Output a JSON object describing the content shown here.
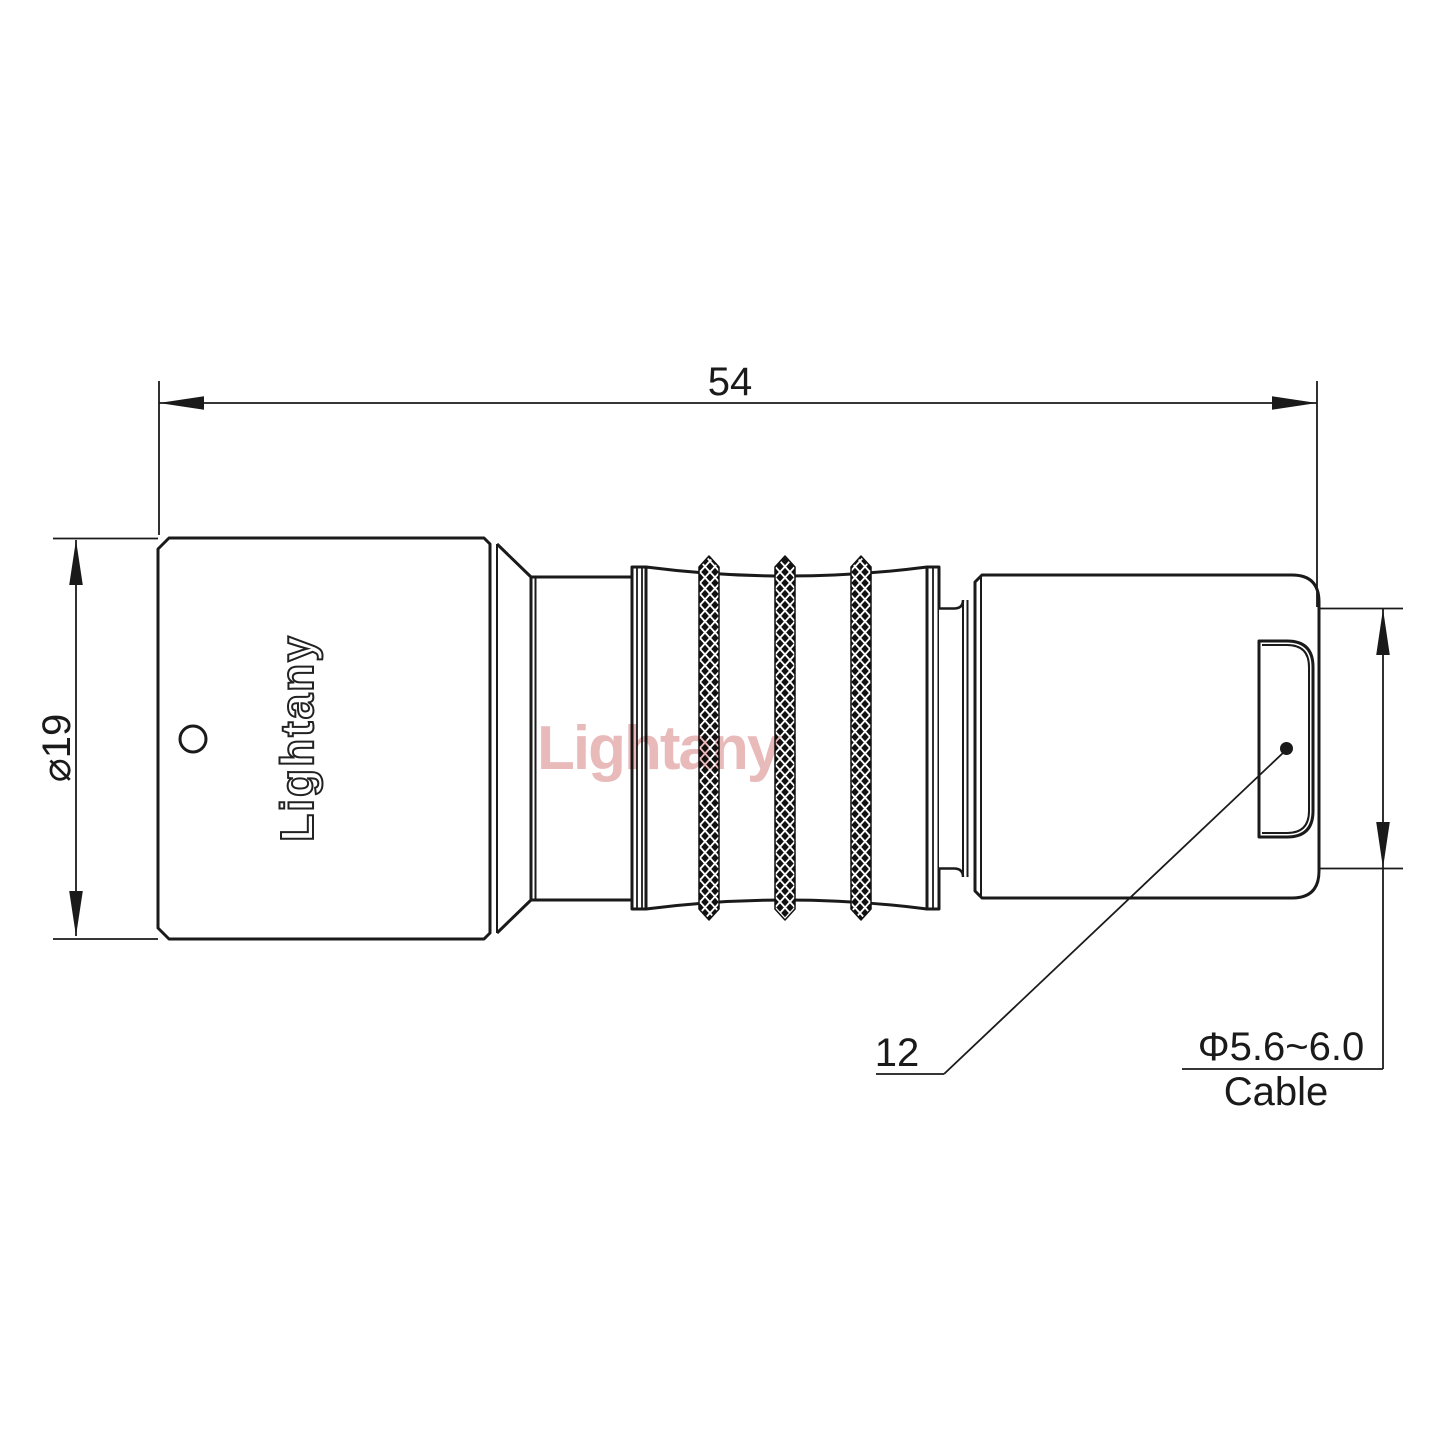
{
  "drawing": {
    "dims": {
      "overall_length": "54",
      "body_diameter": "⌀19",
      "rear_diameter": "12",
      "cable_diameter": "Φ5.6~6.0",
      "cable_label": "Cable"
    },
    "branding": {
      "engraving": "Lightany",
      "watermark": "Lightany"
    },
    "colors": {
      "line": "#1a1a1a",
      "knurl": "#111111",
      "engraving_fill": "#ffffff",
      "engraving_stroke": "#222222",
      "watermark": "#e2a3a3",
      "background": "#ffffff"
    }
  }
}
